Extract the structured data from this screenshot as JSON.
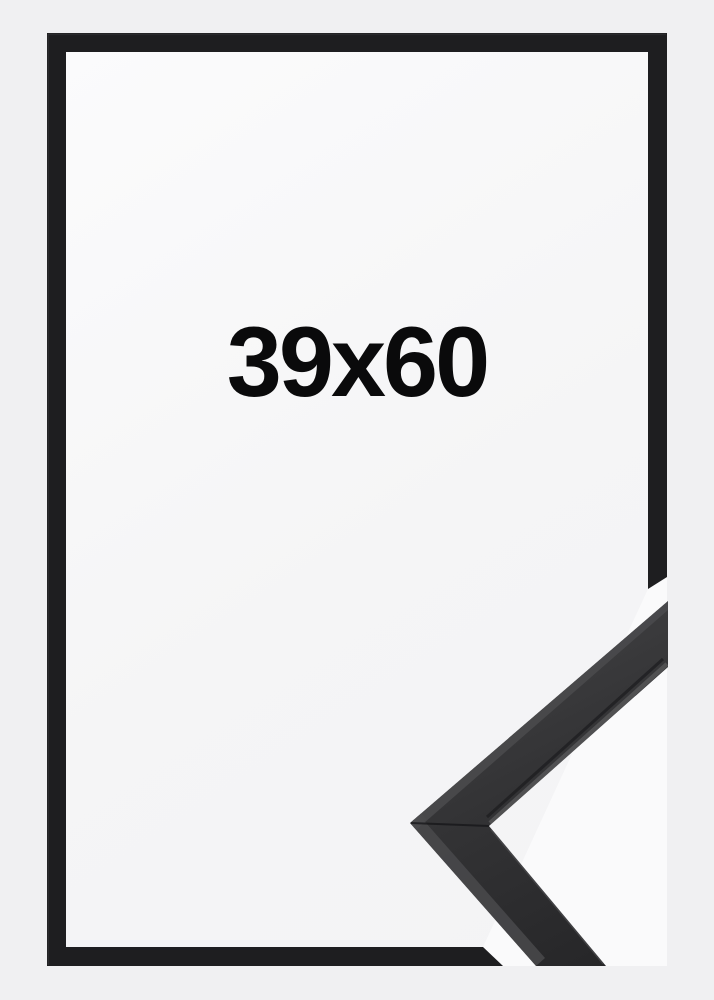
{
  "image": {
    "size_label": "39x60"
  },
  "icons": {
    "frame_border": "black-picture-frame-border",
    "corner_sample": "frame-moulding-corner-sample"
  },
  "colors": {
    "background": "#f0f0f2",
    "opening_white": "#f7f7f8",
    "overlay_white": "#fafafb",
    "frame_black": "#1e1e20",
    "molding_light": "#4b4b4d",
    "molding_mid": "#3a3a3c",
    "molding_dark": "#28282a",
    "label_text": "#0a0a0b"
  }
}
